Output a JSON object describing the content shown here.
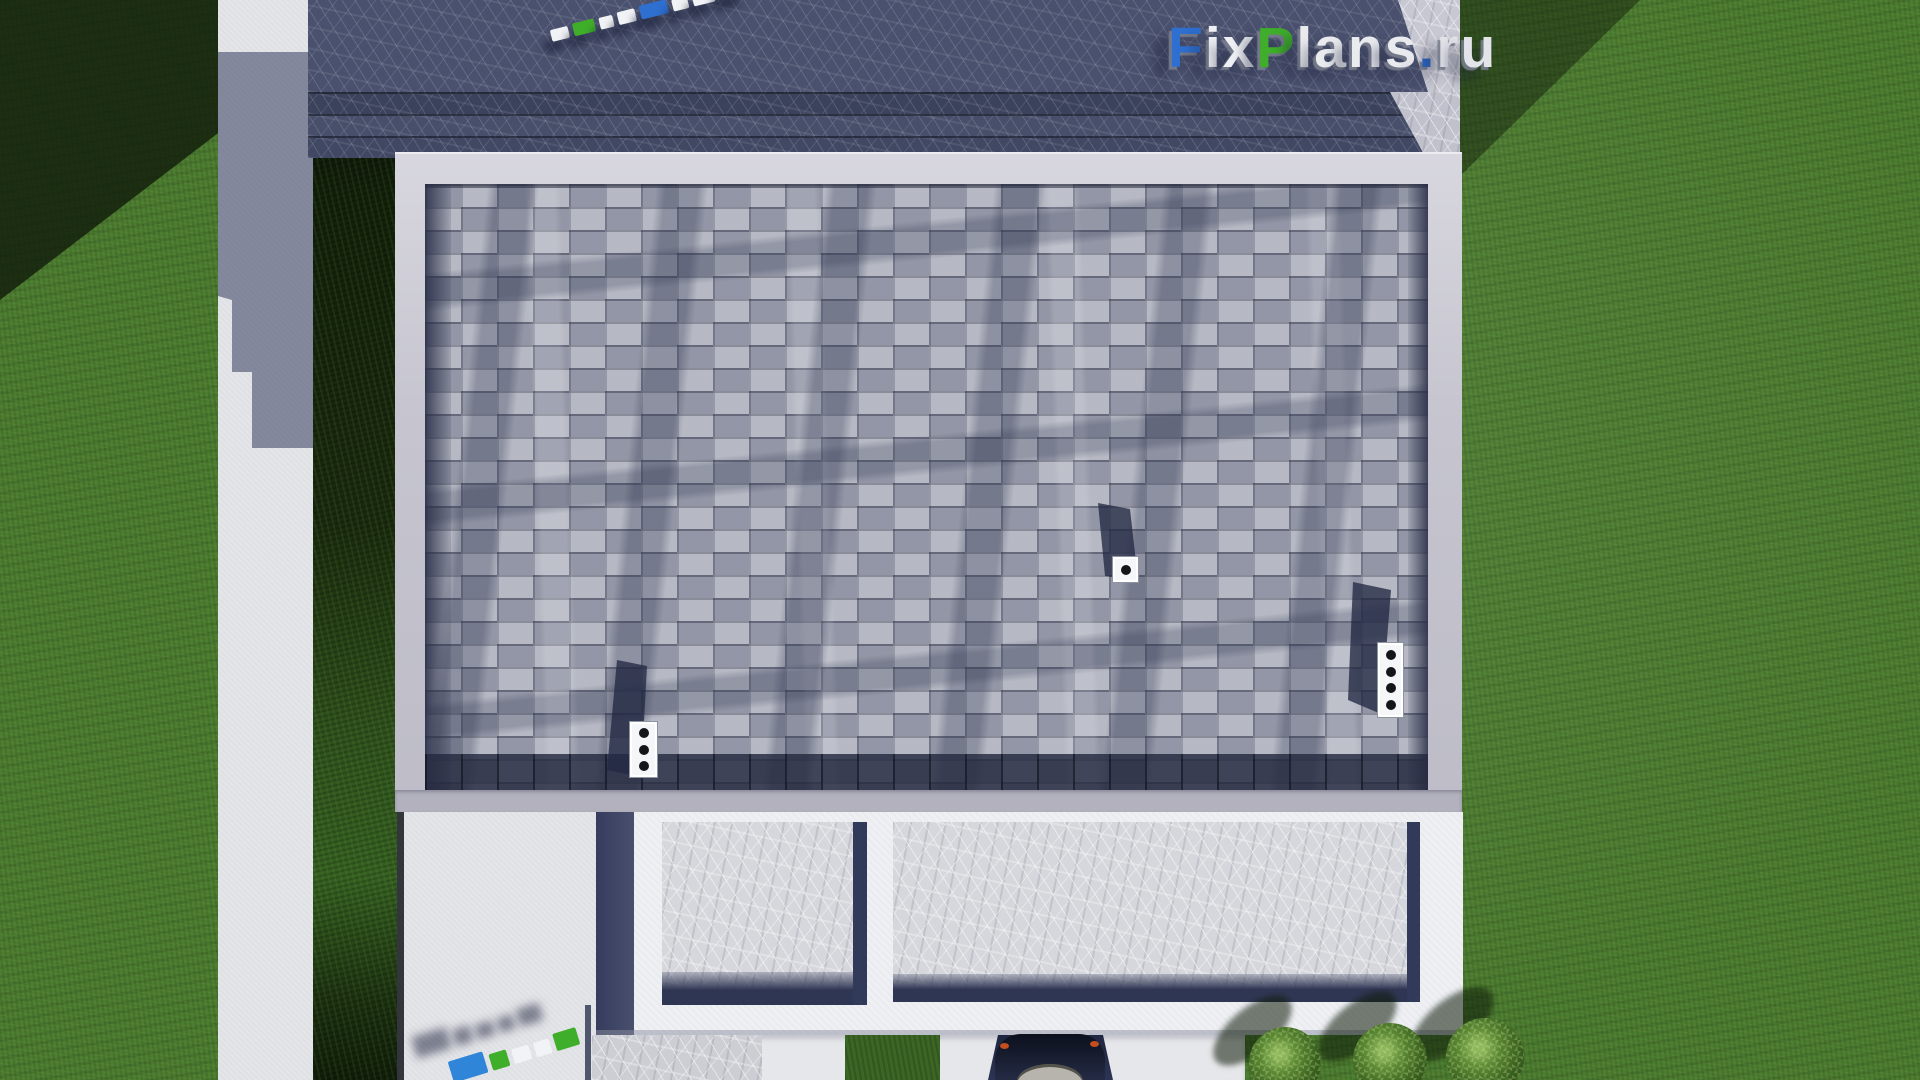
{
  "watermark": {
    "text": "FixPlans.ru",
    "letters": [
      {
        "ch": "F",
        "color": "#2f6fd0"
      },
      {
        "ch": "i",
        "color": "#eef0f4"
      },
      {
        "ch": "x",
        "color": "#eef0f4"
      },
      {
        "ch": "P",
        "color": "#3fae2a"
      },
      {
        "ch": "l",
        "color": "#e9ebef"
      },
      {
        "ch": "a",
        "color": "#e9ebef"
      },
      {
        "ch": "n",
        "color": "#e9ebef"
      },
      {
        "ch": "s",
        "color": "#e9ebef"
      },
      {
        "ch": ".",
        "color": "#2f6fd0"
      },
      {
        "ch": "r",
        "color": "#e2e4ea"
      },
      {
        "ch": "u",
        "color": "#e2e4ea"
      }
    ]
  },
  "scene": {
    "type": "aerial-3d-render",
    "subject": "top-down view of house roof with terrace, walkway, hedge, car and bushes",
    "roof_vents": [
      {
        "name": "roof-vent-left",
        "holes": 3
      },
      {
        "name": "roof-vent-center",
        "holes": 1
      },
      {
        "name": "roof-vent-right",
        "holes": 4
      }
    ],
    "bushes_count": 3,
    "marker_blocks": {
      "top_strip_colors": [
        "#f2f3f6",
        "#3fae2a",
        "#f2f3f6",
        "#f2f3f6",
        "#2f6fd0",
        "#f2f3f6",
        "#f2f3f6",
        "#f2f3f6"
      ],
      "bottom_strip_colors": [
        "#2f86d8",
        "#3fae2a",
        "#f2f3f6",
        "#f2f3f6",
        "#3fae2a"
      ]
    },
    "palette": {
      "grass": "#4c7c30",
      "grass_shadow": "#1d2c12",
      "roof_shingles": "#9da0ae",
      "roof_border": "#c6c5cf",
      "roof_dark_edge": "#2c3149",
      "concrete_light": "#e4e5e9",
      "concrete_shadow": "#4a516e",
      "hedge": "#1b2c10",
      "patio_marble": "#d6d7dc",
      "patio_shadow": "#2f3653",
      "terrace_wall": "#eef0f4",
      "car_body": "#161b2b",
      "car_windshield": "#b6b4ad",
      "logo_blue": "#2f6fd0",
      "logo_green": "#3fae2a",
      "logo_white": "#eef0f4"
    }
  }
}
